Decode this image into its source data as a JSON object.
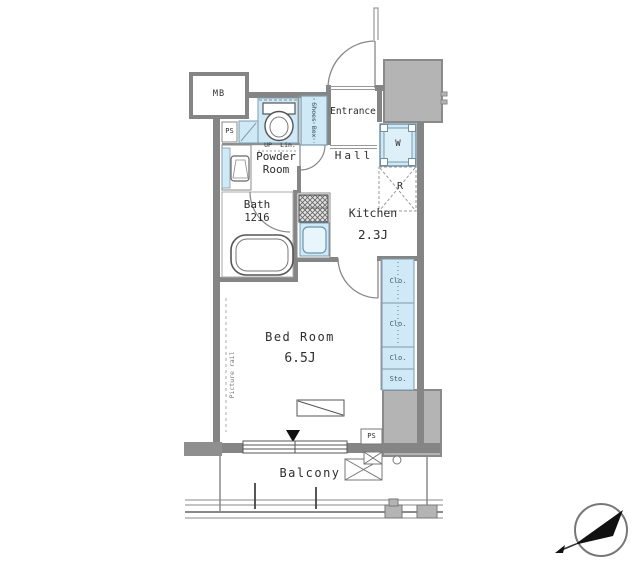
{
  "colors": {
    "wall": "#858585",
    "outside_mass": "#b4b4b4",
    "fixture_blue": "#cfe9f6",
    "fixture_blue_border": "#7c9cae",
    "line_gray": "#777777",
    "text": "#2e2e2e"
  },
  "rooms": {
    "bedroom": {
      "name": "Bed Room",
      "size": "6.5J"
    },
    "kitchen": {
      "name": "Kitchen",
      "size": "2.3J"
    },
    "bath": {
      "name": "Bath",
      "size": "1216"
    },
    "powder": {
      "name": "Powder Room"
    },
    "hall": {
      "name": "Hall"
    },
    "entrance": {
      "name": "Entrance"
    },
    "balcony": {
      "name": "Balcony"
    }
  },
  "fixtures": {
    "meter_box": "MB",
    "pipe_space_top": "PS",
    "pipe_space_bottom": "PS",
    "shoes_box": "Shoes Box",
    "washer": "W",
    "refrigerator": "R",
    "step_up": "UP",
    "linen": "Lin.",
    "closet1": "Clo.",
    "closet2": "Clo.",
    "closet3": "Clo.",
    "storage": "Sto.",
    "picture_rail": "Picture rail"
  }
}
